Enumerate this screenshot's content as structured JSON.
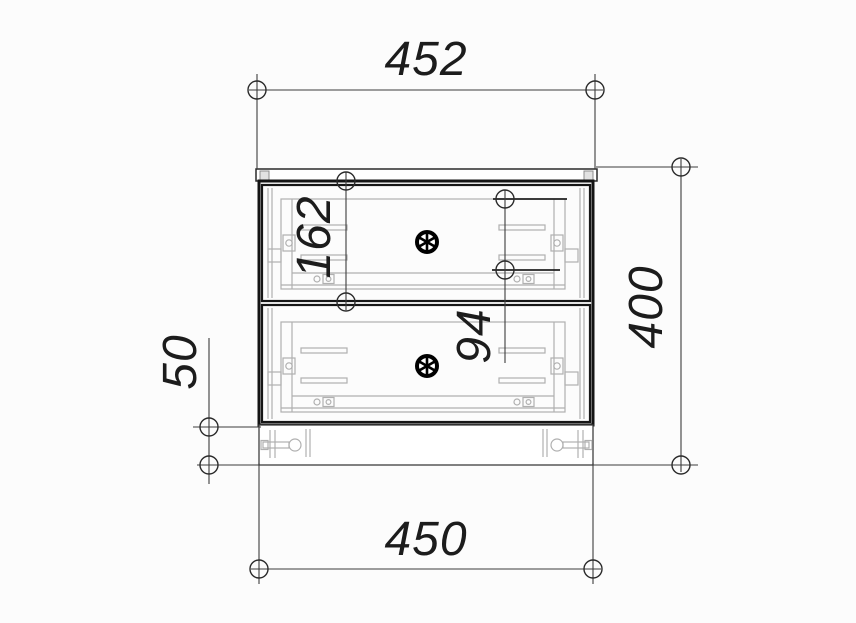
{
  "drawing": {
    "title": "cabinet-front-view-technical-drawing",
    "labels": {
      "top_width": "452",
      "bottom_width": "450",
      "overall_height": "400",
      "drawer_section_height": "162",
      "handle_spacing": "94",
      "plinth_height": "50"
    }
  },
  "icons": {
    "drawer_knob": "spoked-wheel"
  },
  "colors": {
    "background": "#fcfcfc",
    "outline": "#141414",
    "dimension_line": "#3d3d3d",
    "dimension_text": "#1c1c1c",
    "hardware_gray": "#b0b0b0"
  }
}
